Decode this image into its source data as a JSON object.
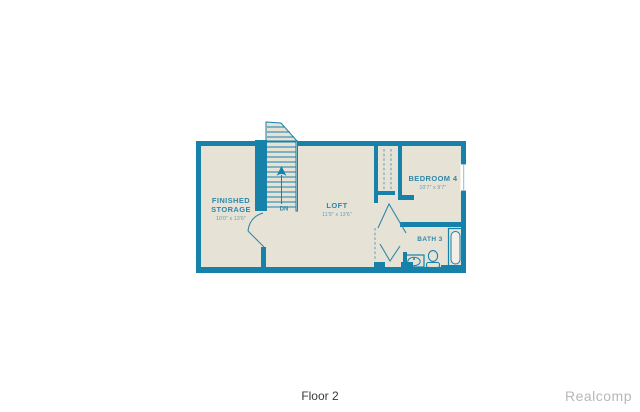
{
  "image": {
    "caption": "Floor 2",
    "watermark": "Realcomp"
  },
  "floor_plan": {
    "rooms": [
      {
        "id": "finished-storage",
        "name_line1": "FINISHED",
        "name_line2": "STORAGE",
        "dims": "10'0\" x 13'6\""
      },
      {
        "id": "loft",
        "name": "LOFT",
        "dims": "11'9\" x 13'6\""
      },
      {
        "id": "bedroom-4",
        "name": "BEDROOM 4",
        "dims": "10'7\" x 9'7\""
      },
      {
        "id": "bath-3",
        "name": "BATH 3"
      }
    ],
    "stairs": {
      "direction_label": "DN"
    },
    "colors": {
      "wall": "#1681a9",
      "floor": "#e7e2d6",
      "label_text": "#2f87aa",
      "caption_text": "#3b3b3b",
      "watermark_text": "#b8b8b8"
    }
  }
}
